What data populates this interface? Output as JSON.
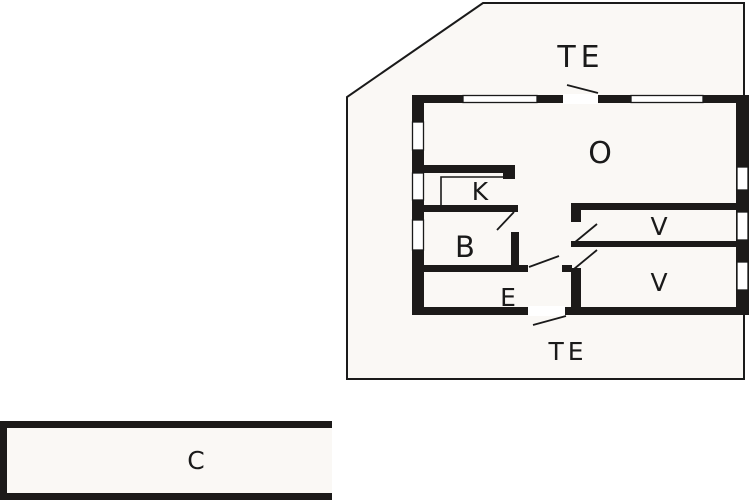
{
  "meta": {
    "type": "architectural-floor-plan",
    "description": "Single storey house plan with terraces and detached carport"
  },
  "colors": {
    "wall": "#1c1a19",
    "outline": "#1a1a1a",
    "floor": "#faf8f5",
    "window": "#ffffff",
    "background": "#ffffff"
  },
  "floor_plan": {
    "rooms": [
      {
        "id": "terrace-top",
        "label": "TE"
      },
      {
        "id": "living-room",
        "label": "O"
      },
      {
        "id": "kitchen",
        "label": "K"
      },
      {
        "id": "bathroom",
        "label": "B"
      },
      {
        "id": "entry",
        "label": "E"
      },
      {
        "id": "bedroom-upper",
        "label": "V"
      },
      {
        "id": "bedroom-lower",
        "label": "V"
      },
      {
        "id": "terrace-bottom",
        "label": "TE"
      },
      {
        "id": "carport",
        "label": "C"
      }
    ]
  }
}
